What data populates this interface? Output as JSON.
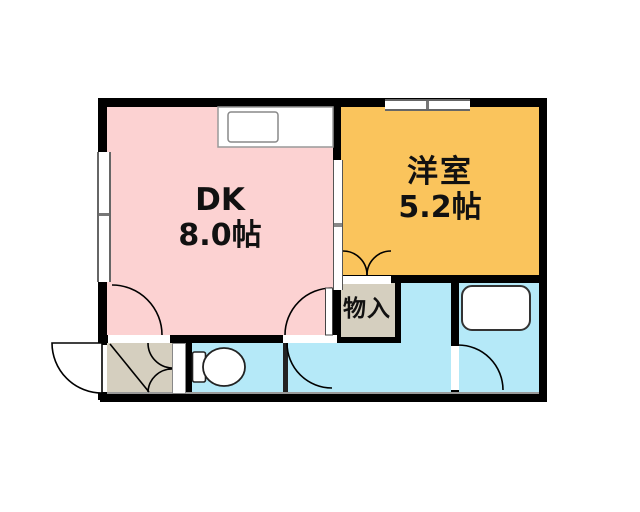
{
  "plan": {
    "type": "apartment-floor-plan",
    "rooms": {
      "dk": {
        "label": "DK",
        "size": "8.0帖"
      },
      "western": {
        "label": "洋室",
        "size": "5.2帖"
      },
      "storage": {
        "label": "物入"
      }
    },
    "colors": {
      "dk_floor": "#FCD2D2",
      "western_floor": "#FAC45C",
      "wet_area_floor": "#B5E9F8",
      "entry_storage_floor": "#D5CFBF",
      "wall": "#000000",
      "background": "#FFFFFF"
    },
    "icons": [
      "kitchen-counter-icon",
      "kitchen-sink-icon",
      "toilet-icon",
      "bathtub-icon",
      "window-icon",
      "sliding-door-icon",
      "door-swing-icon"
    ]
  }
}
